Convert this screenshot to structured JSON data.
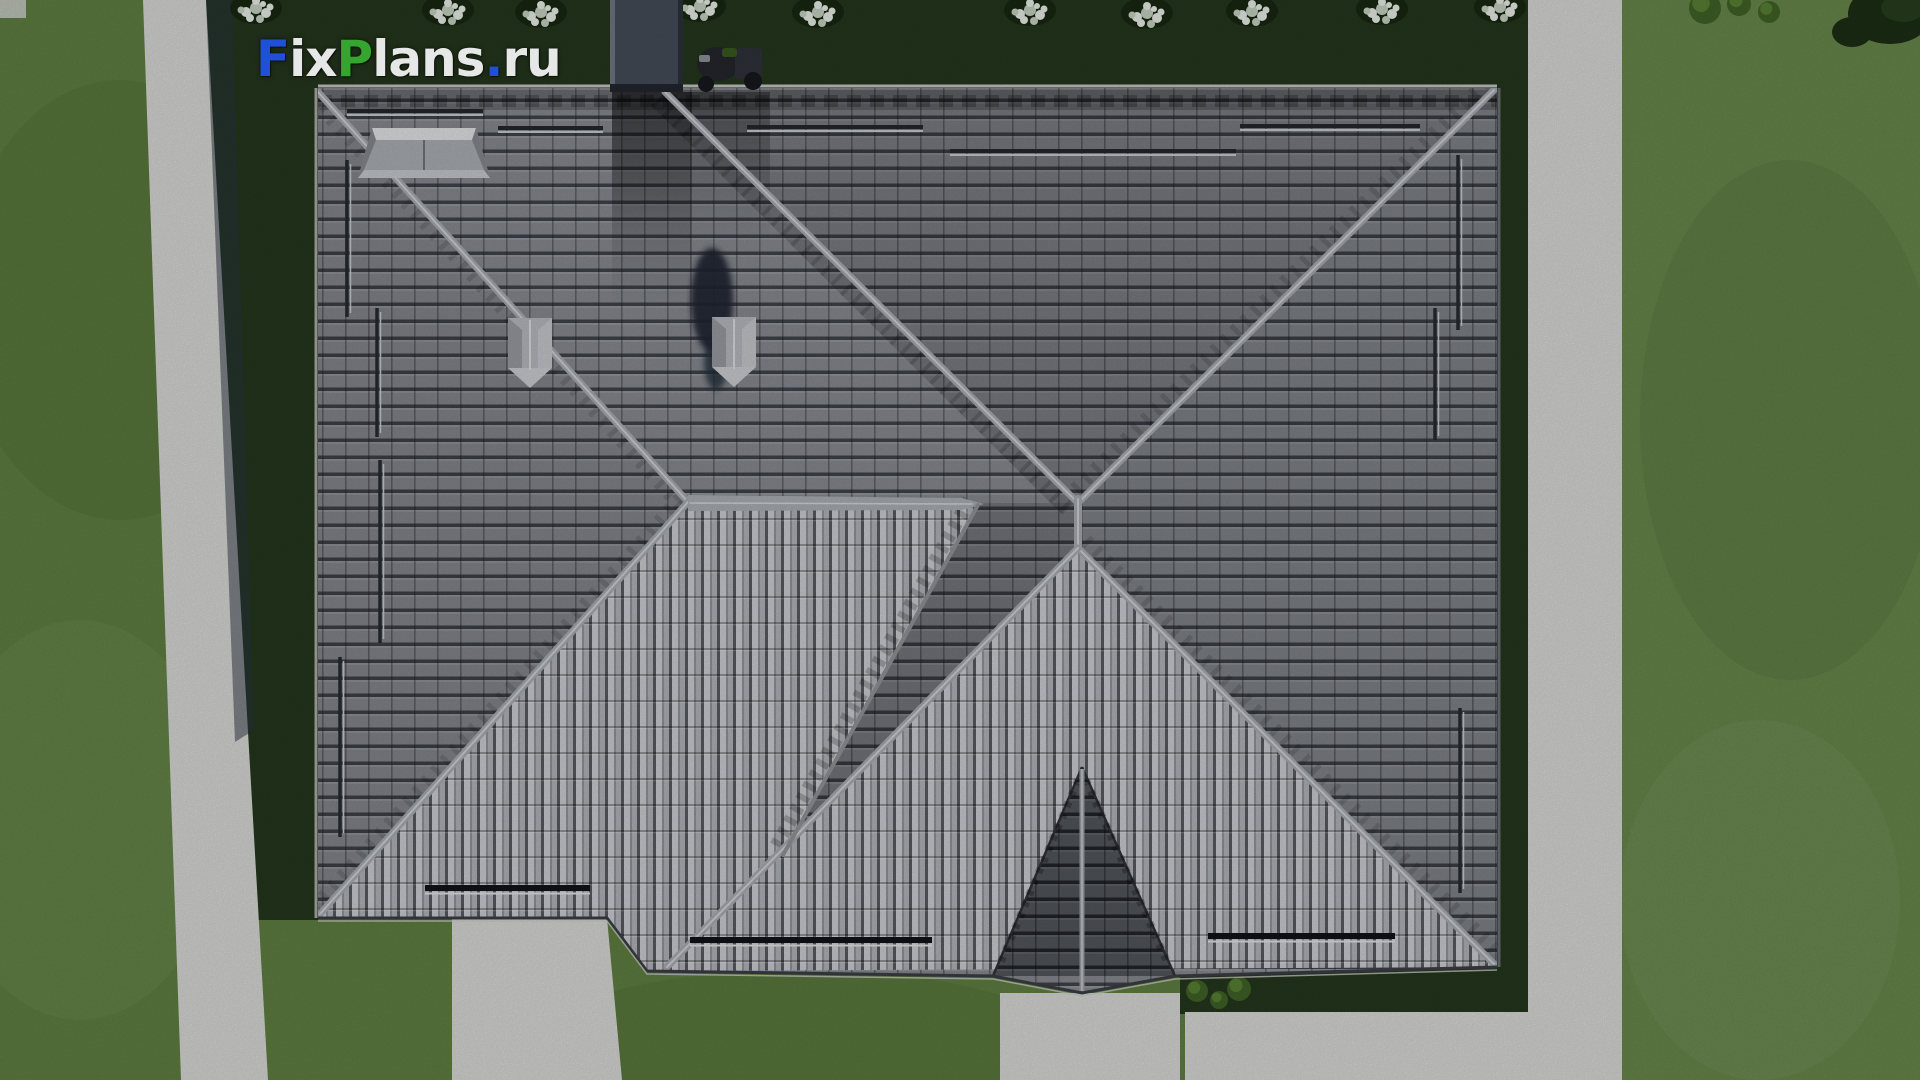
{
  "watermark": {
    "full_text": "FixPlans.ru",
    "f": "F",
    "ix": "ix",
    "p": "P",
    "lans": "lans",
    "dot": ".",
    "ru": "ru",
    "blue": "#2050d8",
    "green": "#35a52f",
    "white": "#e6e8e8"
  },
  "palette": {
    "lawn": "#5e7e40",
    "lawn_right": "#66864a",
    "lawn_dark": "#24361c",
    "walkway": "#d6d7d3",
    "roof_tile": "#84878d",
    "roof_tile_shadow": "#3f424a",
    "roof_rib_light": "#c7c9ce",
    "ridge": "#a6a9ae",
    "porch_tile": "#63666d",
    "chimney": "#454c57",
    "skylight": "#a9adb3",
    "white_bush": "#e6ebe4"
  }
}
